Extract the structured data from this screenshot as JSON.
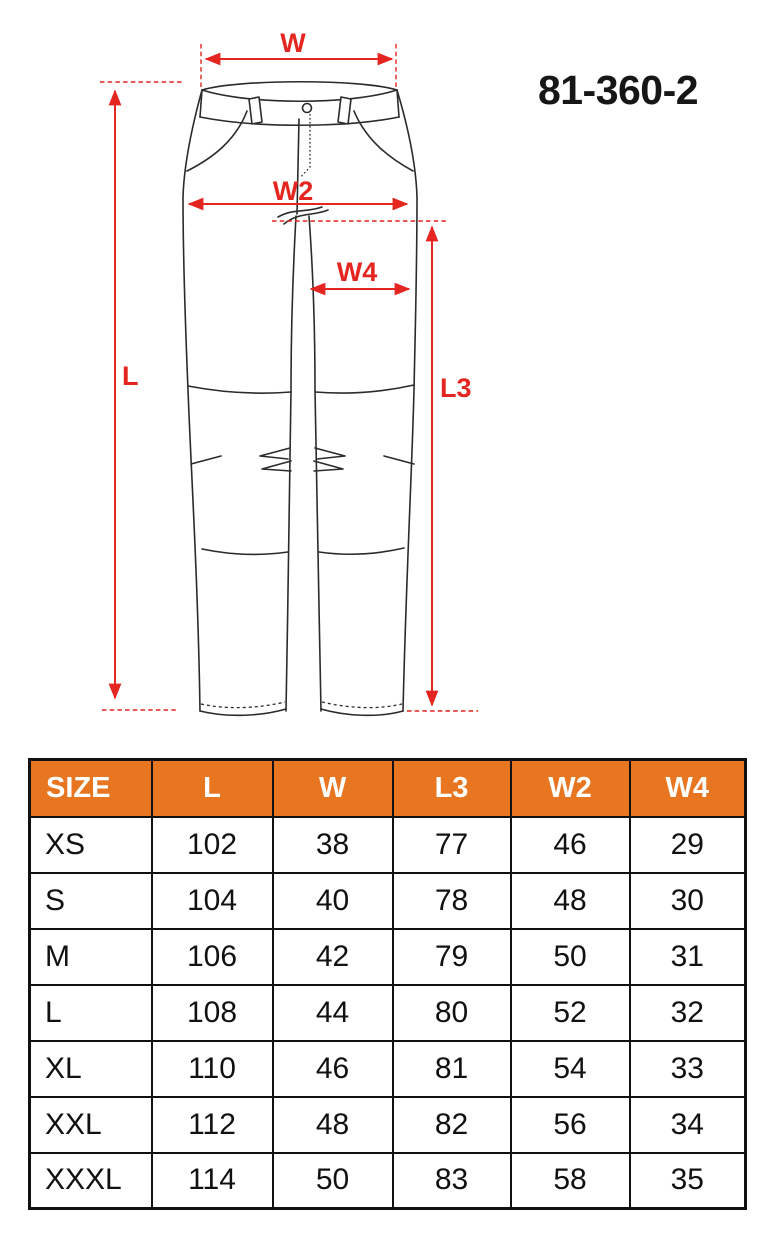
{
  "product": {
    "code": "81-360-2"
  },
  "colors": {
    "accent_orange": "#e87520",
    "dimension_red": "#e42520",
    "line_color": "#2b2b2b",
    "header_text": "#ffffff",
    "code_color": "#161616"
  },
  "diagram": {
    "description": "technical line drawing of work trousers with red dimension arrows",
    "labels": {
      "w": "W",
      "w2": "W2",
      "w4": "W4",
      "l": "L",
      "l3": "L3"
    }
  },
  "table": {
    "columns": [
      "SIZE",
      "L",
      "W",
      "L3",
      "W2",
      "W4"
    ],
    "rows": [
      {
        "size": "XS",
        "l": "102",
        "w": "38",
        "l3": "77",
        "w2": "46",
        "w4": "29"
      },
      {
        "size": "S",
        "l": "104",
        "w": "40",
        "l3": "78",
        "w2": "48",
        "w4": "30"
      },
      {
        "size": "M",
        "l": "106",
        "w": "42",
        "l3": "79",
        "w2": "50",
        "w4": "31"
      },
      {
        "size": "L",
        "l": "108",
        "w": "44",
        "l3": "80",
        "w2": "52",
        "w4": "32"
      },
      {
        "size": "XL",
        "l": "110",
        "w": "46",
        "l3": "81",
        "w2": "54",
        "w4": "33"
      },
      {
        "size": "XXL",
        "l": "112",
        "w": "48",
        "l3": "82",
        "w2": "56",
        "w4": "34"
      },
      {
        "size": "XXXL",
        "l": "114",
        "w": "50",
        "l3": "83",
        "w2": "58",
        "w4": "35"
      }
    ]
  }
}
